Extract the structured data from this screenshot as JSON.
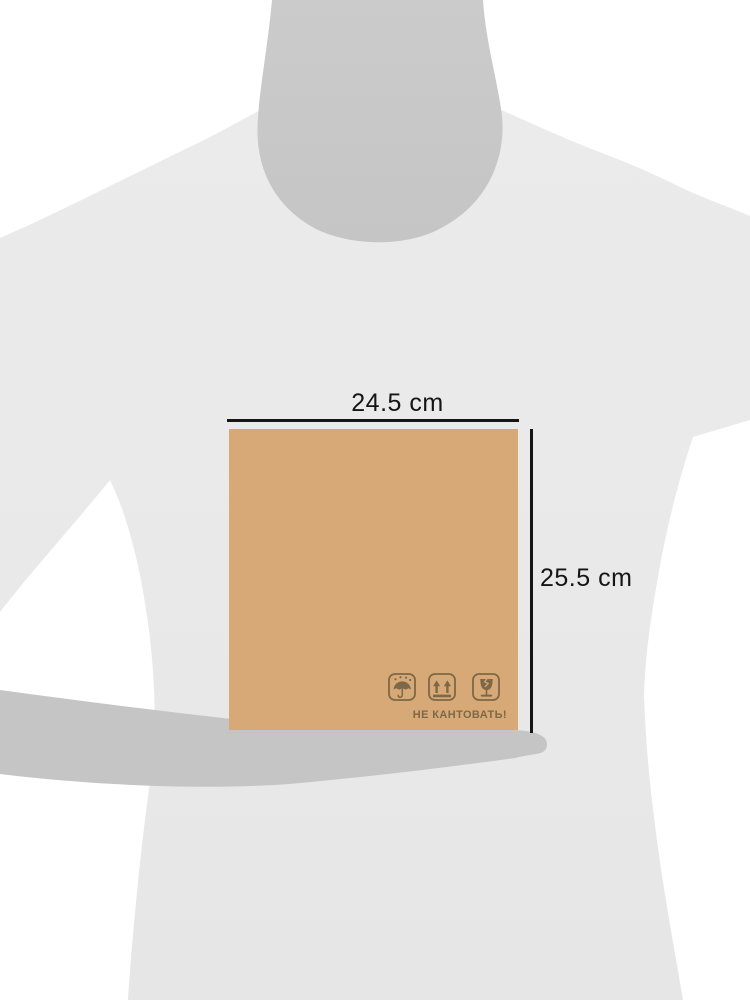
{
  "dimension_annotations": {
    "width_label": "24.5 cm",
    "height_label": "25.5 cm"
  },
  "package": {
    "caption": "НЕ КАНТОВАТЬ!",
    "icons": [
      {
        "name": "keep-dry-icon",
        "meaning": "umbrella with raindrops (keep dry)"
      },
      {
        "name": "this-side-up-icon",
        "meaning": "two up arrows over bar (this side up)"
      },
      {
        "name": "fragile-icon",
        "meaning": "broken wine glass (fragile)"
      }
    ]
  },
  "colors": {
    "background": "#ffffff",
    "tshirt": "#e9e9e9",
    "neck": "#c9c9c9",
    "arm": "#c5c5c5",
    "box": "#d7a977",
    "marking": "#7d6847",
    "dimension_line": "#151515"
  }
}
